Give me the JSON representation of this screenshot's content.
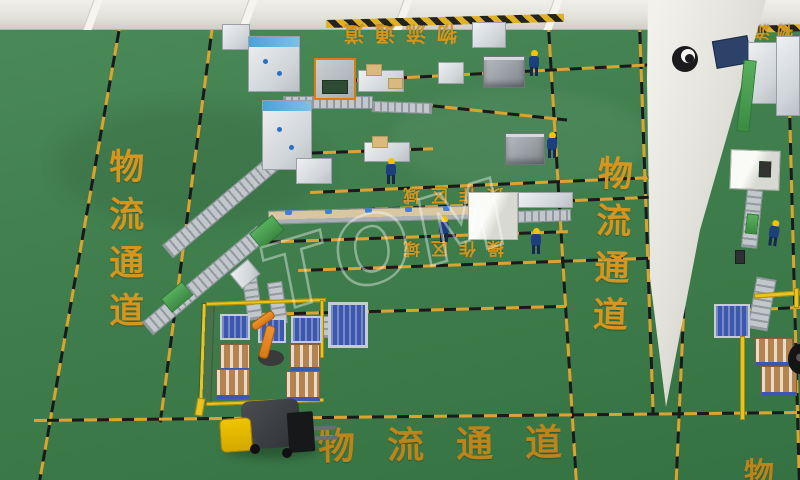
{
  "scene": {
    "description": "3D isometric rendering of an automated packaging factory floor with conveyors, palletizing robot, forklift and marked logistics corridors",
    "floor_color": "#3f7b4c",
    "lane_yellow": "#dda32e",
    "lane_black": "#1a1a1a",
    "floor_label_color": "#d6951c",
    "wall_color": "#e2e1da",
    "robot_color": "#e8821e",
    "pallet_color": "#3c57ae",
    "carton_color": "#b5834f",
    "forklift_color": "#e6b400",
    "worker_uniform_color": "#1d3f7c",
    "helmet_color": "#f2c400"
  },
  "labels": {
    "corridor_left": "物流通道",
    "corridor_right": "物流通道",
    "corridor_bottom": "物流通道",
    "corridor_top": "物流通道",
    "corridor_top_right": "物流通",
    "operation_area_upper": "操作区域",
    "operation_area_lower": "操作区域",
    "corridor_bottom_right_partial": "物"
  },
  "watermark": {
    "text": "TOM"
  }
}
